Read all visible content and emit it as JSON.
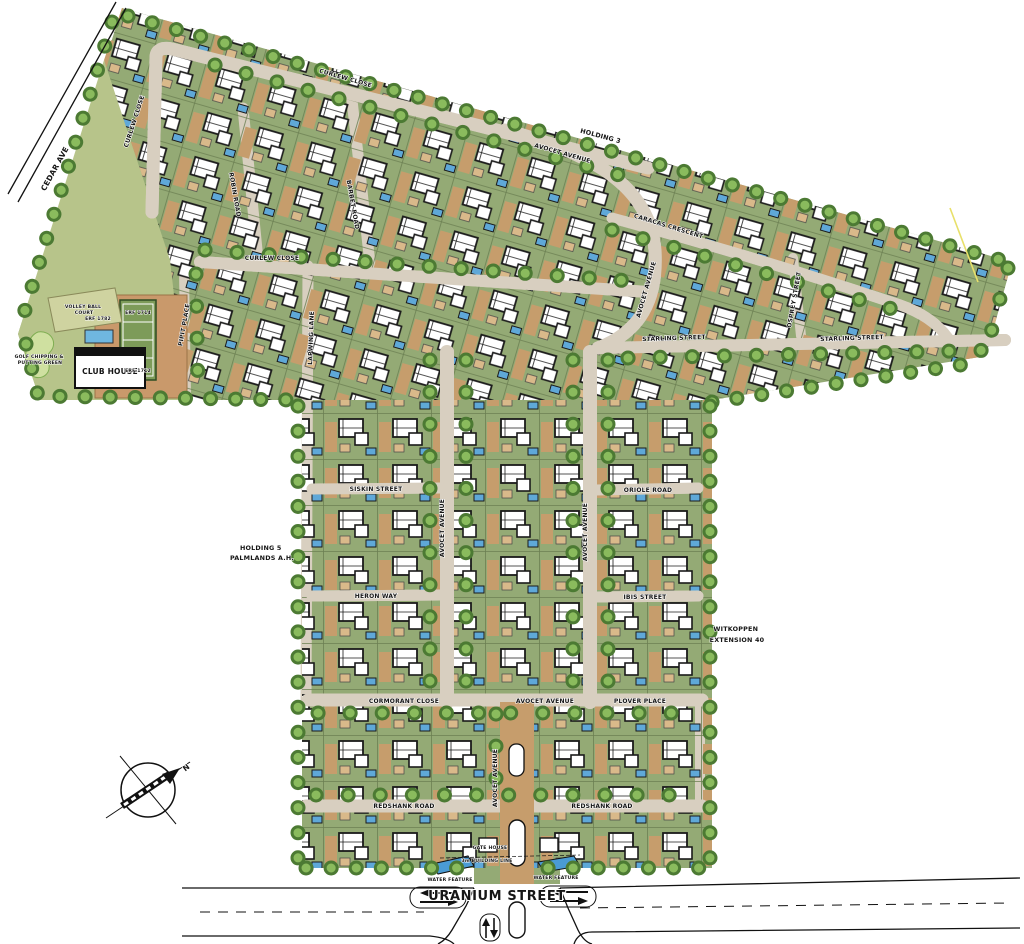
{
  "map": {
    "streets": {
      "cedar_ave": "CEDAR AVE",
      "curlew_close": "CURLEW CLOSE",
      "robin_road": "ROBIN ROAD",
      "barbet_road": "BARBET ROAD",
      "lapwing_lane": "LAPWING LANE",
      "pipit_place": "PIPIT PLACE",
      "avocet_avenue": "AVOCET AVENUE",
      "caracas_crescent": "CARACAS CRESCENT",
      "osprey_street": "OSPREY STREET",
      "starling_street": "STARLING STREET",
      "siskin_street": "SISKIN STREET",
      "oriole_road": "ORIOLE ROAD",
      "heron_way": "HERON WAY",
      "ibis_street": "IBIS STREET",
      "cormorant_close": "CORMORANT CLOSE",
      "plover_place": "PLOVER PLACE",
      "redshank_road": "REDSHANK ROAD",
      "uranium_street": "URANIUM STREET"
    },
    "areas": {
      "holding_3": "HOLDING 3",
      "holding_5_line1": "HOLDING 5",
      "holding_5_line2": "PALMLANDS A.H.",
      "witkoppen_line1": "WITKOPPEN",
      "witkoppen_line2": "EXTENSION 40"
    },
    "amenities": {
      "club_house": "CLUB HOUSE",
      "volleyball_line1": "VOLLEY BALL",
      "volleyball_line2": "COURT",
      "golf_line1": "GOLF CHIPPING &",
      "golf_line2": "PUTTING GREEN",
      "gate_house": "GATE HOUSE",
      "building_line": "3m BUILDING LINE",
      "water_feature": "WATER FEATURE",
      "erf_a": "ERF 1782",
      "erf_b": "ERF 1714",
      "erf_c": "ERF 1712"
    },
    "compass": {
      "north": "N"
    },
    "colors": {
      "lot_green": "#94aa75",
      "open_green": "#b7c48a",
      "road_beige": "#d8cfc0",
      "driveway_tan": "#c69d6c",
      "tree_dark": "#4c7a33",
      "tree_light": "#8abb5d",
      "pool_blue": "#5fa8d8",
      "court_green": "#7d9b59",
      "boundary_yellow": "#e8e06a"
    }
  }
}
